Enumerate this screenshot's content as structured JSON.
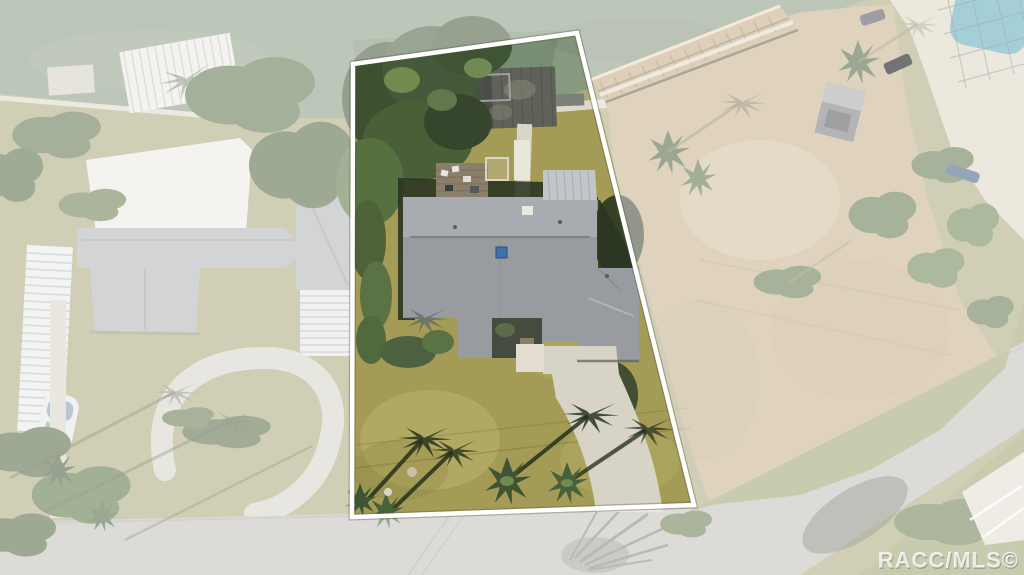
{
  "watermark": {
    "text": "RACC/MLS©"
  },
  "boundary": {
    "label": "highlighted-lot-boundary",
    "color": "#ffffff"
  },
  "colors": {
    "water": "#87997f",
    "water_shade": "#6e8468",
    "grass_yard": "#a49b56",
    "grass_yard_light": "#bcb46c",
    "grass_yard_dark": "#8c8445",
    "grass_left": "#aaa878",
    "grass_verge": "#9ba06c",
    "dirt": "#c7b088",
    "dirt_light": "#d6c49e",
    "road": "#c0beb9",
    "concrete": "#d7d3c6",
    "roof_main": "#989ca0",
    "roof_main_light": "#a8acb0",
    "roof_white": "#eceae4",
    "roof_shingle": "#b0b2b4",
    "metal_roof": "#c3c6c8",
    "tree_dark": "#3d5130",
    "tree_mid": "#56703f",
    "tree_light": "#74894e",
    "shadow_dark": "#222d19",
    "dock_wood": "#5e6258",
    "deck_wood": "#8a7f6b",
    "boardwalk_wood": "#c2a87e",
    "pool": "#5aa8b8",
    "skylight": "#3f72aa",
    "wash": "#ffffff"
  }
}
